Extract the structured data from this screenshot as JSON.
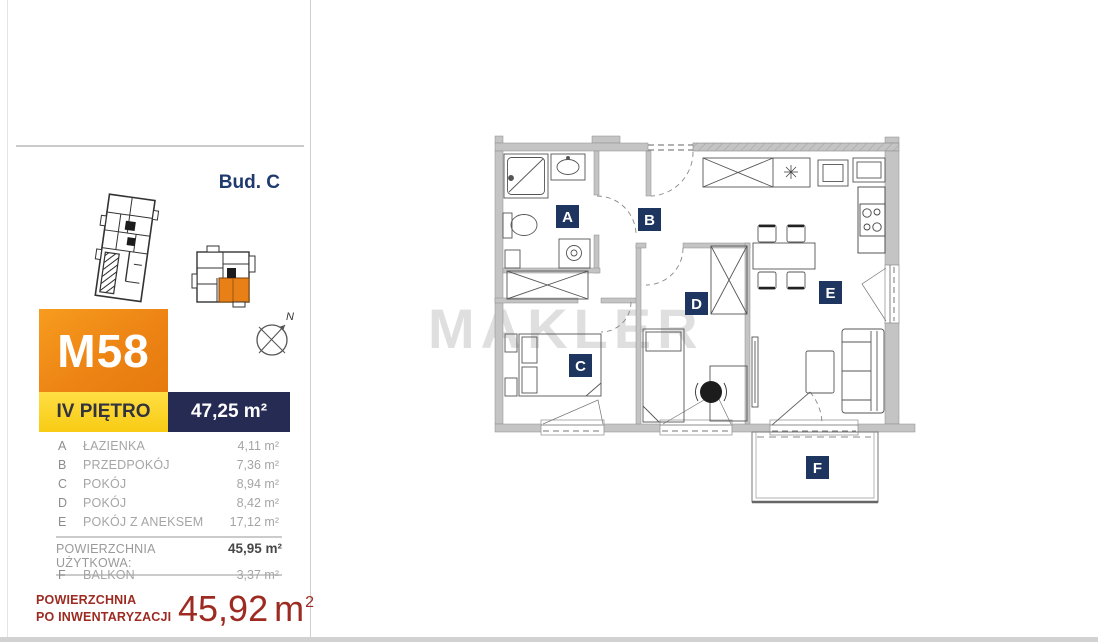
{
  "sidebar": {
    "building_label": "Bud. C",
    "unit": {
      "id": "M58",
      "floor": "IV PIĘTRO",
      "area": "47,25 m²"
    },
    "rooms": [
      {
        "letter": "A",
        "name": "ŁAZIENKA",
        "area": "4,11 m²"
      },
      {
        "letter": "B",
        "name": "PRZEDPOKÓJ",
        "area": "7,36 m²"
      },
      {
        "letter": "C",
        "name": "POKÓJ",
        "area": "8,94 m²"
      },
      {
        "letter": "D",
        "name": "POKÓJ",
        "area": "8,42 m²"
      },
      {
        "letter": "E",
        "name": "POKÓJ Z ANEKSEM",
        "area": "17,12 m²"
      }
    ],
    "usable": {
      "label": "POWIERZCHNIA UŻYTKOWA:",
      "area": "45,95 m²"
    },
    "balcony": {
      "letter": "F",
      "name": "BALKON",
      "area": "3,37 m²"
    },
    "inventory": {
      "label_line1": "POWIERZCHNIA",
      "label_line2": "PO INWENTARYZACJI",
      "value": "45,92",
      "unit": "m",
      "sup": "2"
    }
  },
  "plan": {
    "watermark": "MAKLER",
    "compass_n": "N",
    "labels": {
      "a": "A",
      "b": "B",
      "c": "C",
      "d": "D",
      "e": "E",
      "f": "F"
    }
  },
  "colors": {
    "accent_orange": "#ed8414",
    "accent_yellow": "#f8cb13",
    "navy_box": "#262b54",
    "plan_label_navy": "#1e3560",
    "title_navy": "#1f3a6e",
    "inventory_red": "#9d2b21",
    "wall_gray": "#c4c4c4",
    "watermark_gray": "#dcdcdc"
  }
}
